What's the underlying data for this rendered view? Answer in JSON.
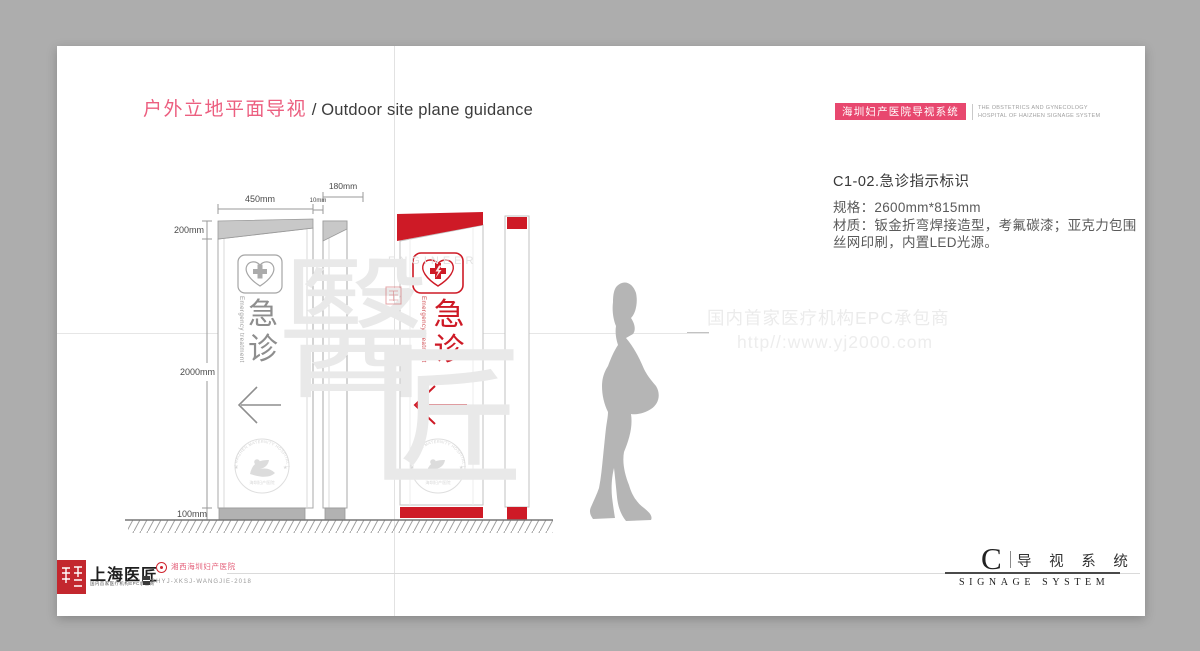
{
  "window": {
    "backdrop_color": "#adadad"
  },
  "header": {
    "title_zh": "户外立地平面导视",
    "title_sep": " / ",
    "title_en": "Outdoor site plane guidance",
    "badge": {
      "label": "海圳妇产医院导视系统",
      "sub1": "THE OBSTETRICS AND GYNECOLOGY",
      "sub2": "HOSPITAL OF HAIZHEN  SIGNAGE SYSTEM"
    }
  },
  "spec": {
    "title": "C1-02.急诊指示标识",
    "size": "规格：2600mm*815mm",
    "material1": "材质：钣金折弯焊接造型，考氟碳漆；亚克力包围",
    "material2": "丝网印刷，内置LED光源。"
  },
  "site_watermark": {
    "line1": "国内首家医疗机构EPC承包商",
    "line2": "http//:www.yj2000.com"
  },
  "drawing": {
    "dims": {
      "w450": "450mm",
      "w10": "10mm",
      "w180": "180mm",
      "h200": "200mm",
      "h2000": "2000mm",
      "h100": "100mm"
    },
    "sign": {
      "chars": [
        "急",
        "诊"
      ],
      "subtitle": "Emergency treatment"
    },
    "seal": {
      "arc": "( HAIZHEN MATERNITY HOSPITAL )",
      "bottom": "海圳妇产医院",
      "star": "★"
    },
    "wm": {
      "c1": "醫",
      "c2": "匠",
      "brand": "ENGINEER"
    }
  },
  "footer": {
    "left": {
      "brand": "上海医匠",
      "brand_sub": "国内首家医疗机构EPC承包商",
      "partner": "湘西海圳妇产医院",
      "code": "SHYJ-XKSJ-WANGJIE-2018"
    },
    "right": {
      "letter": "C",
      "zh": "导 视 系 统",
      "en": "SIGNAGE SYSTEM"
    }
  },
  "colors": {
    "accent_pink": "#e8486f",
    "sign_red": "#ce1a26",
    "drawing_gray": "#8e8e8e"
  }
}
